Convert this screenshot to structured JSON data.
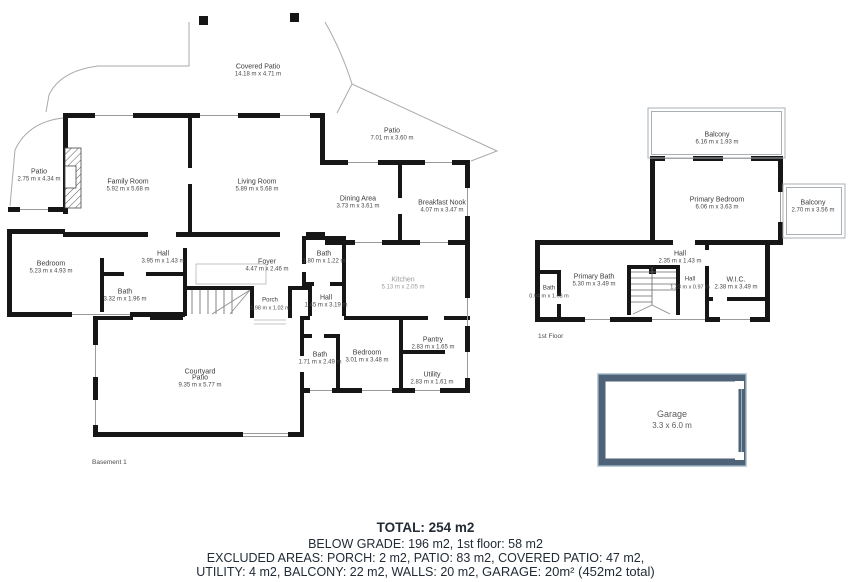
{
  "rooms": {
    "covered_patio": {
      "name": "Covered Patio",
      "dims": "14.18 m x 4.71 m"
    },
    "patio_left": {
      "name": "Patio",
      "dims": "2.75 m x 4.34 m"
    },
    "family_room": {
      "name": "Family Room",
      "dims": "5.92 m x 5.68 m"
    },
    "living_room": {
      "name": "Living Room",
      "dims": "5.89 m x 5.68 m"
    },
    "patio_top": {
      "name": "Patio",
      "dims": "7.01 m x 3.60 m"
    },
    "dining_area": {
      "name": "Dining Area",
      "dims": "3.73 m x 3.61 m"
    },
    "breakfast_nook": {
      "name": "Breakfast Nook",
      "dims": "4.07 m x 3.47 m"
    },
    "bedroom_left": {
      "name": "Bedroom",
      "dims": "5.23 m x 4.93 m"
    },
    "hall_b1": {
      "name": "Hall",
      "dims": "3.95 m x 1.43 m"
    },
    "bath_b1": {
      "name": "Bath",
      "dims": "3.32 m x 1.96 m"
    },
    "foyer": {
      "name": "Foyer",
      "dims": "4.47 m x 2.46 m"
    },
    "bath_b2": {
      "name": "Bath",
      "dims": "1.80 m x 1.22 m"
    },
    "kitchen": {
      "name": "Kitchen",
      "dims": "5.13 m x 2.05 m"
    },
    "hall_b2": {
      "name": "Hall",
      "dims": "1.45 m x 3.19 m"
    },
    "porch": {
      "name": "Porch",
      "dims": "1.98 m x 1.02 m"
    },
    "bath_b3": {
      "name": "Bath",
      "dims": "1.71 m x 2.49 m"
    },
    "bedroom_b2": {
      "name": "Bedroom",
      "dims": "3.01 m x 3.48 m"
    },
    "pantry": {
      "name": "Pantry",
      "dims": "2.83 m x 1.65 m"
    },
    "utility": {
      "name": "Utility",
      "dims": "2.83 m x 1.61 m"
    },
    "courtyard": {
      "name": "Courtyard",
      "name2": "Patio",
      "dims": "9.35 m x 5.77 m"
    },
    "balcony_top": {
      "name": "Balcony",
      "dims": "6.16 m x 1.93 m"
    },
    "primary_bedroom": {
      "name": "Primary Bedroom",
      "dims": "6.06 m x 3.63 m"
    },
    "balcony_right": {
      "name": "Balcony",
      "dims": "2.70 m x 3.56 m"
    },
    "hall_f1": {
      "name": "Hall",
      "dims": "2.35 m x 1.43 m"
    },
    "primary_bath": {
      "name": "Primary Bath",
      "dims": "5.30 m x 3.49 m"
    },
    "hall_f2": {
      "name": "Hall",
      "dims": "1.23 m x 0.97 m"
    },
    "wic": {
      "name": "W.I.C.",
      "dims": "2.38 m x 3.49 m"
    },
    "bath_f1": {
      "name": "Bath",
      "dims": "0.94 m x 1.68 m"
    }
  },
  "garage": {
    "name": "Garage",
    "dims": "3.3 x 6.0 m"
  },
  "floors": {
    "basement": "Basement 1",
    "first": "1st Floor"
  },
  "footer": {
    "total": "TOTAL: 254 m2",
    "line2": "BELOW GRADE: 196 m2, 1st floor: 58 m2",
    "line3": "EXCLUDED AREAS: PORCH: 2 m2, PATIO: 83 m2, COVERED PATIO: 47 m2,",
    "line4": "UTILITY: 4 m2, BALCONY: 22 m2, WALLS: 20 m2,",
    "garage_note": "GARAGE: 20m² (452m2 total)"
  },
  "colors": {
    "wall": "#161616",
    "thin_line": "#a8a8a8",
    "garage_wall": "#4e6377",
    "garage_outline": "#bccfdb",
    "footer_text": "#222b36"
  }
}
